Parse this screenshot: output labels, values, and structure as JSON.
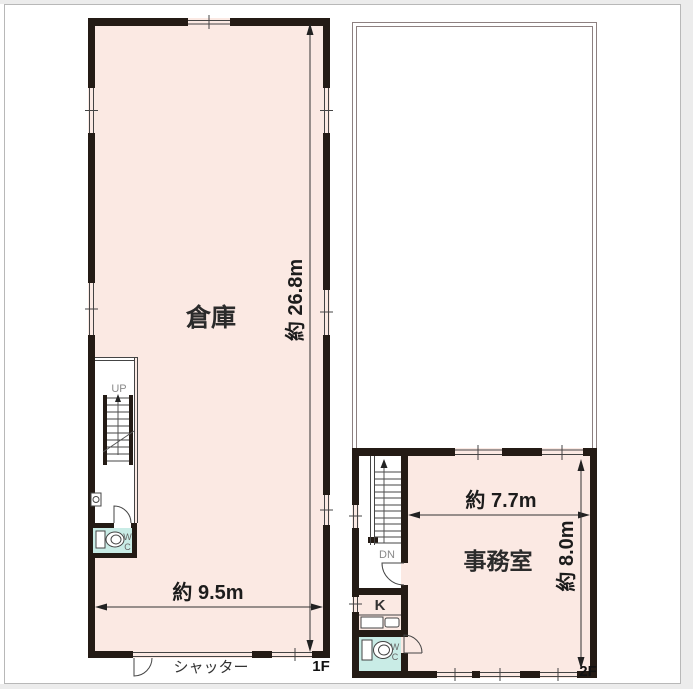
{
  "floor_1f": {
    "floor_label": "1F",
    "room_name": "倉庫",
    "dim_height": "約 26.8m",
    "dim_width": "約 9.5m",
    "shutter_label": "シャッター",
    "stair_direction": "UP",
    "wc_w": "W",
    "wc_c": "C"
  },
  "floor_2f": {
    "floor_label": "2F",
    "room_name": "事務室",
    "dim_width": "約 7.7m",
    "dim_height": "約 8.0m",
    "stair_direction": "DN",
    "kitchen_label": "K",
    "wc_w": "W",
    "wc_c": "C"
  },
  "colors": {
    "room_fill": "#fbe9e3",
    "wc_fill": "#c9ece6",
    "wall": "#241b15",
    "void_outline": "#8d8080",
    "frame_border": "#b8b8b8"
  }
}
